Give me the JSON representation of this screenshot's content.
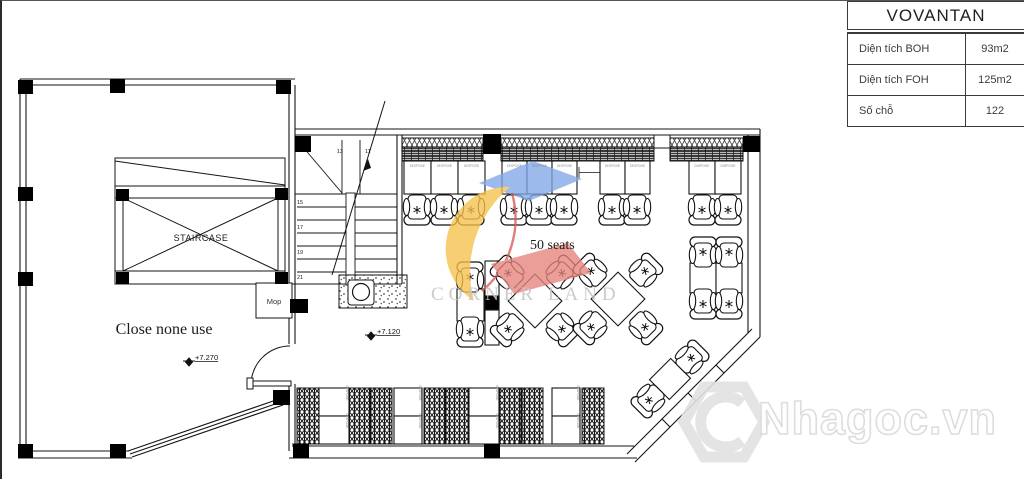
{
  "info_table": {
    "title": "VOVANTAN",
    "rows": [
      {
        "label": "Diện tích BOH",
        "value": "93m2"
      },
      {
        "label": "Diện tích FOH",
        "value": "125m2"
      },
      {
        "label": "Số chỗ",
        "value": "122"
      }
    ]
  },
  "plan": {
    "staircase_label": "STAIRCASE",
    "closed_area_label": "Close none use",
    "mop_label": "Mop",
    "seats_label": "50 seats",
    "level_left": "+7.270",
    "level_main": "+7.120",
    "stair_numbers": {
      "n13": "13",
      "n11": "11",
      "n15": "15",
      "n17": "17",
      "n19": "19",
      "n21": "21"
    },
    "table_tag": "DISPOSE"
  },
  "watermarks": {
    "corner_land": "CORNER LAND",
    "nhagoc": "Nhagoc.vn",
    "colors": {
      "yellow": "#F6C14B",
      "blue": "#82A7E8",
      "red": "#E5837B",
      "red_line": "#D65C54"
    }
  }
}
